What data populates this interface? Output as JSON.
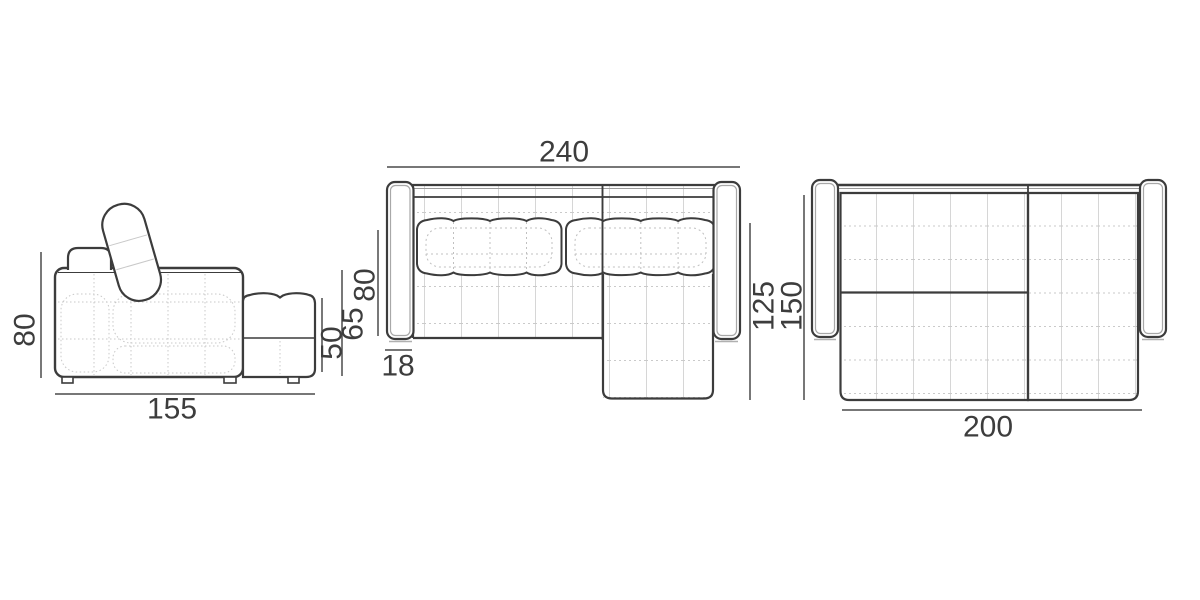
{
  "colors": {
    "background": "#ffffff",
    "outline": "#3c3c3c",
    "dimension_line": "#4a4a4a",
    "light_detail": "#c8c8c8",
    "grid_line": "#d4d4d4",
    "text": "#3d3d3d"
  },
  "views": {
    "side": {
      "dim_height": "80",
      "dim_depth": "155",
      "dim_seat_height": "65",
      "dim_chaise_height": "50"
    },
    "top": {
      "dim_width": "240",
      "dim_seat_depth": "80",
      "dim_armrest_width": "18",
      "dim_chaise_length": "125"
    },
    "bed": {
      "dim_depth": "150",
      "dim_width": "200"
    }
  }
}
